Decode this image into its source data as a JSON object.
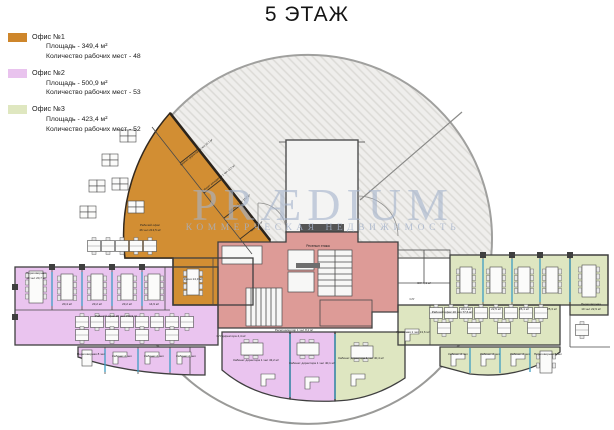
{
  "title": "5 ЭТАЖ",
  "legend": {
    "items": [
      {
        "label": "Офис №1",
        "area": "Площадь - 349,4 м²",
        "seats": "Количество рабочих мест - 48",
        "color": "#CE862B"
      },
      {
        "label": "Офис №2",
        "area": "Площадь - 500,9 м²",
        "seats": "Количество рабочих мест - 53",
        "color": "#E9C3EE"
      },
      {
        "label": "Офис №3",
        "area": "Площадь - 423,4 м²",
        "seats": "Количество рабочих мест - 52",
        "color": "#DFE7C0"
      }
    ]
  },
  "watermark": {
    "text": "PRÆDIUM",
    "subtitle": "КОММЕРЧЕСКАЯ НЕДВИЖИМОСТЬ"
  },
  "colors": {
    "office1": "#D28E33",
    "office2": "#EAC4EF",
    "office3": "#DEE6C1",
    "core": "#DD9B97",
    "hatch_line": "#DBDAD6",
    "hatch_bg": "#EFEEEC",
    "glass": "#3E9EC4"
  },
  "plan": {
    "labels": [
      {
        "t": "Ресепшн этажа"
      },
      {
        "t": "Кабинет директора 1 чел 10,7 м²"
      },
      {
        "t": "Кабинет менеджера 1 чел 11,5 м²"
      },
      {
        "t": "Кабинет 2 чел 10,2 м²"
      },
      {
        "t": "Кухня 9,9 м²"
      },
      {
        "t": "Рабочий офис"
      },
      {
        "t": "46 чел 213,5 м²"
      },
      {
        "t": "Кухня 14,3 м²"
      },
      {
        "t": "Переговорная"
      },
      {
        "t": "10 чел 20,7 м²"
      },
      {
        "t": "20,4 м²"
      },
      {
        "t": "23,2 м²"
      },
      {
        "t": "23,2 м²"
      },
      {
        "t": "14,9 м²"
      },
      {
        "t": "Рабочий офис 26 чел 150,9 м²"
      },
      {
        "t": "Переговорная 8 чел"
      },
      {
        "t": "Кабинет 2 чел"
      },
      {
        "t": "Кабинет 2 чел"
      },
      {
        "t": "Кабинет 2 чел"
      },
      {
        "t": "С/У директора 4,4 м²"
      },
      {
        "t": "Ресепшн/копир 1 чел 8,2 м²"
      },
      {
        "t": "Кабинет директора 1 чел 43,2 м²"
      },
      {
        "t": "Кабинет директора 1 чел 40,1 м²"
      },
      {
        "t": "Кабинет директора 1 чел 40,4 м²"
      },
      {
        "t": "С/У 4,1 м²"
      },
      {
        "t": "С/У"
      },
      {
        "t": "20,1 м²"
      },
      {
        "t": "22,5 м²"
      },
      {
        "t": "26,1 м²"
      },
      {
        "t": "25,3 м²"
      },
      {
        "t": "Переговорная"
      },
      {
        "t": "10 чел 22,9 м²"
      },
      {
        "t": "Рабочий офис 20 чел 77,6 м²"
      },
      {
        "t": "Приемная 1 чел 13,6 м²"
      },
      {
        "t": "Кабинет 2 чел"
      },
      {
        "t": "Кабинет 2 чел"
      },
      {
        "t": "Кабинет 2 чел"
      },
      {
        "t": "Переговорная 6 чел"
      }
    ]
  }
}
